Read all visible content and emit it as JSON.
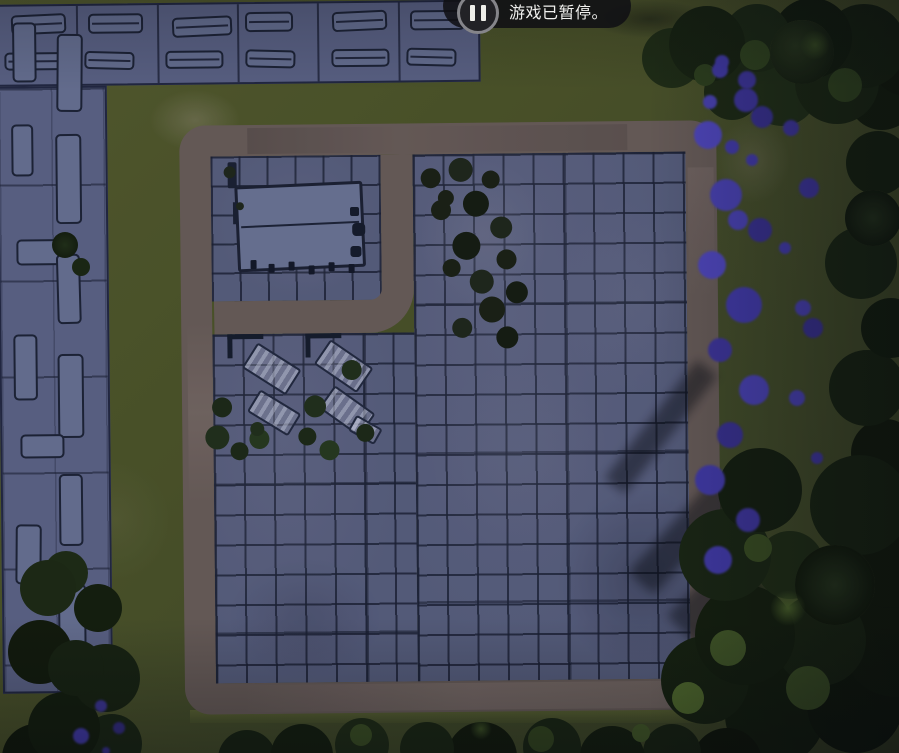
{
  "hud": {
    "pause_notification": {
      "label": "游戏已暂停。",
      "icon": "pause-icon"
    }
  },
  "icons": {
    "pause-icon": "two-vertical-bars-in-circle"
  },
  "palette": {
    "grass": "#4f5628",
    "grass_light": "#6d7048",
    "road": "#6d5f5a",
    "field_tile": "#5b6181",
    "field_line": "#1a1f32",
    "building_lot": "#5f668a",
    "building_roof": "#6b7497",
    "building_outline": "#1d2336",
    "tree_dark": "#16200e",
    "tree_light": "#3e5322",
    "flower": "#4c43b8",
    "toast_bg": "#101014",
    "toast_text": "#f0f0ee"
  }
}
